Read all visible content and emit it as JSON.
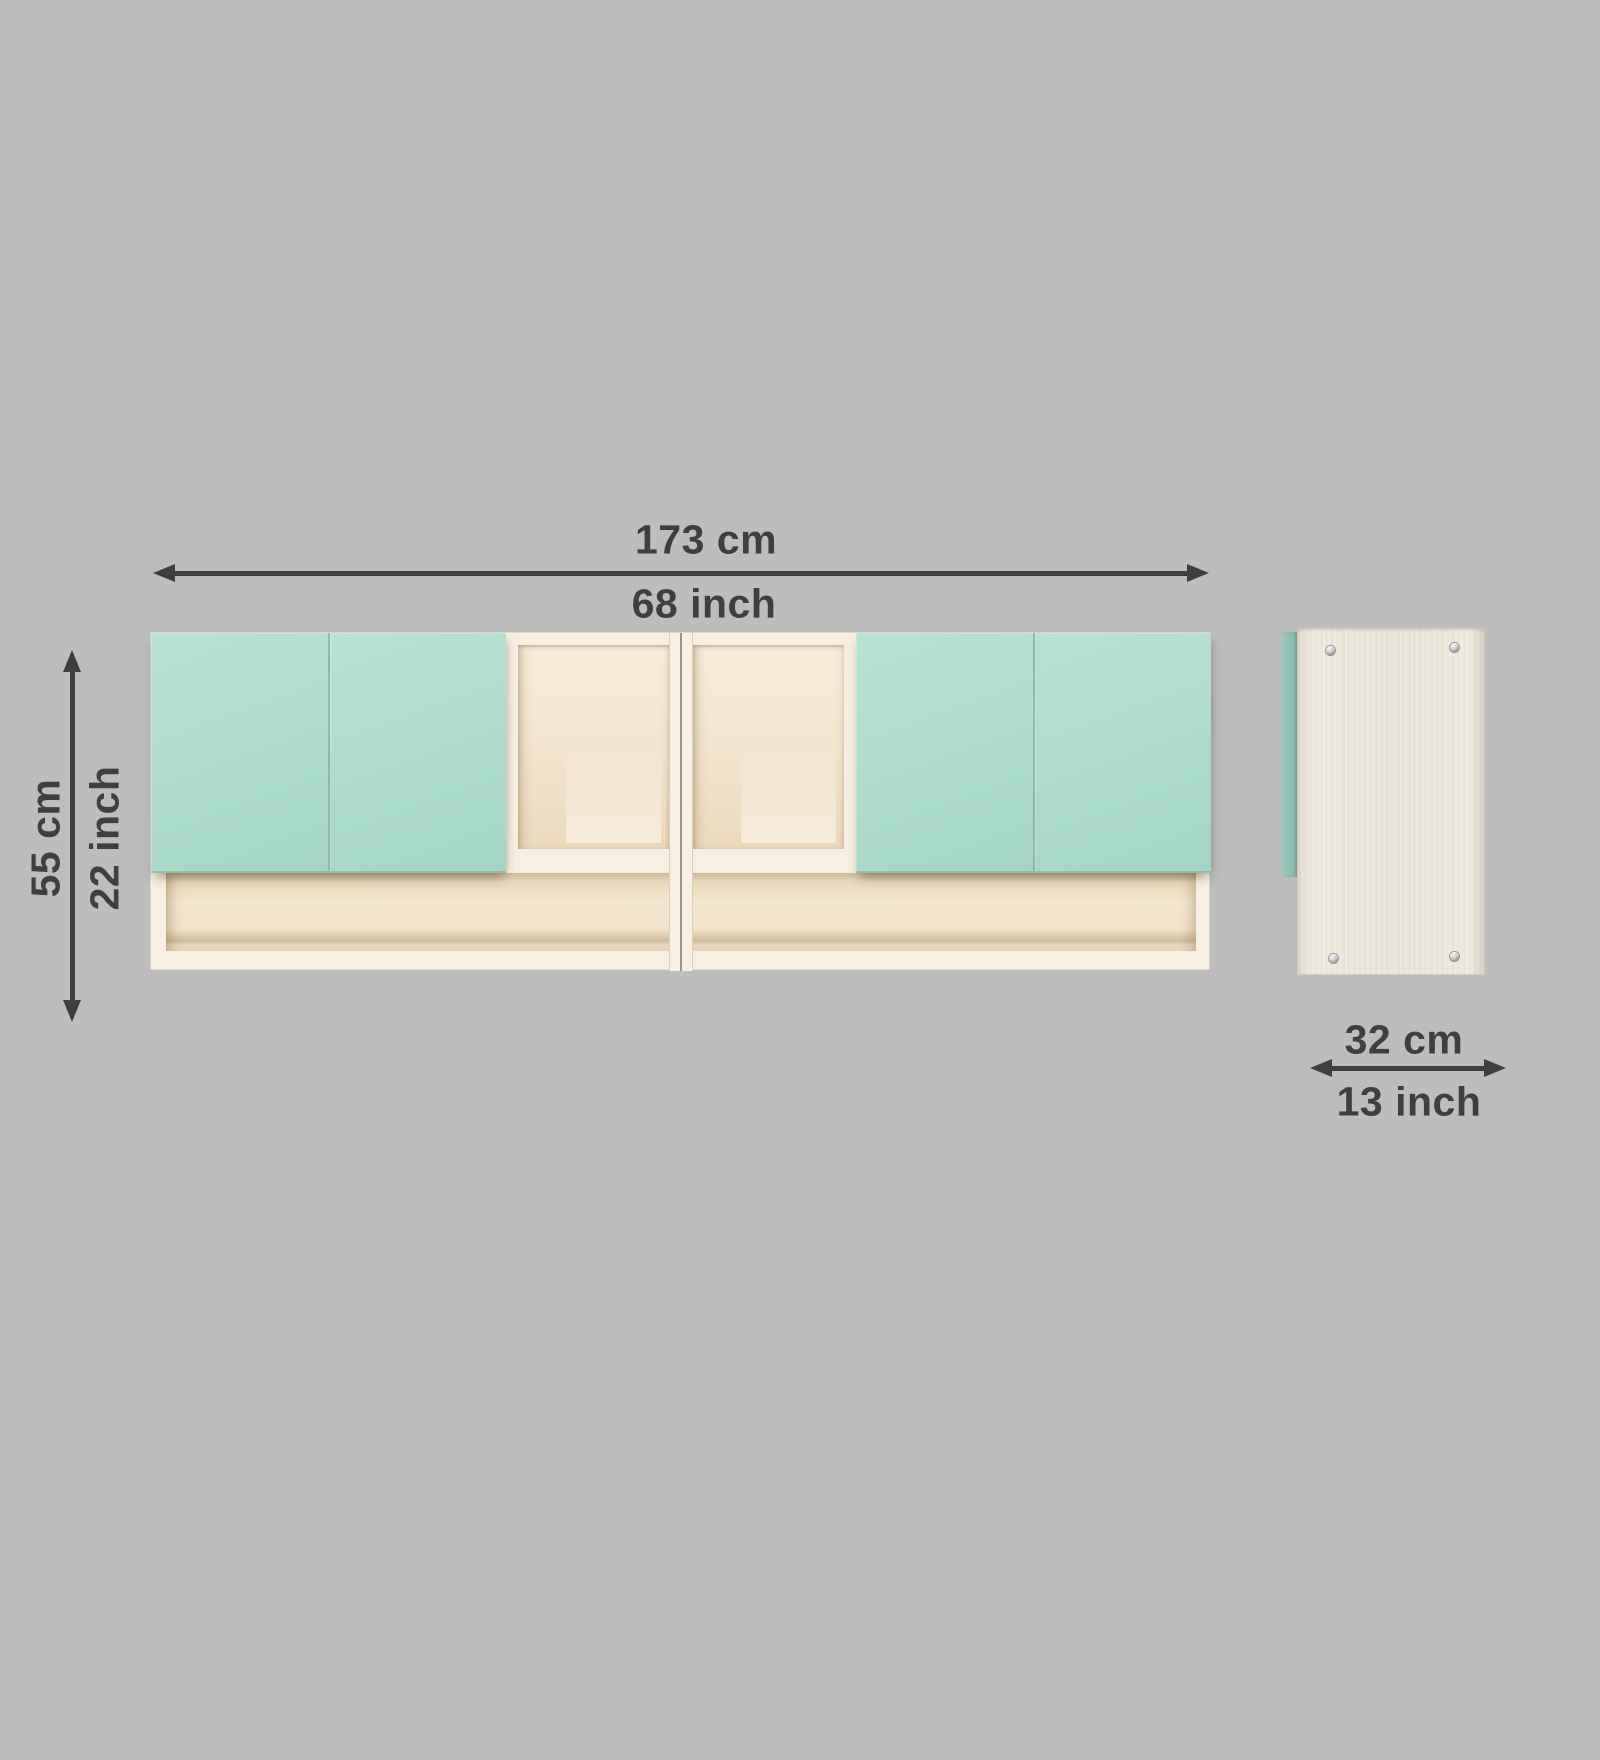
{
  "diagram": {
    "background_color": "#bdbdbd",
    "annotation_text_color": "#3f3f42",
    "arrow_color": "#3e3e40"
  },
  "dimensions": {
    "width": {
      "cm": "173 cm",
      "inch": "68 inch"
    },
    "height": {
      "cm": "55 cm",
      "inch": "22 inch"
    },
    "depth": {
      "cm": "32 cm",
      "inch": "13 inch"
    }
  },
  "cabinet": {
    "front_view": {
      "door_color": "#aedccd",
      "frame_color": "#f7efe1",
      "interior_color": "#f3e5cd",
      "left_door_count": 2,
      "right_door_count": 2,
      "open_compartment_count": 2,
      "bottom_shelf_section_count": 2
    },
    "side_view": {
      "panel_color": "#ebe8de",
      "door_edge_color": "#8fc0b3",
      "screw_count": 4
    }
  }
}
